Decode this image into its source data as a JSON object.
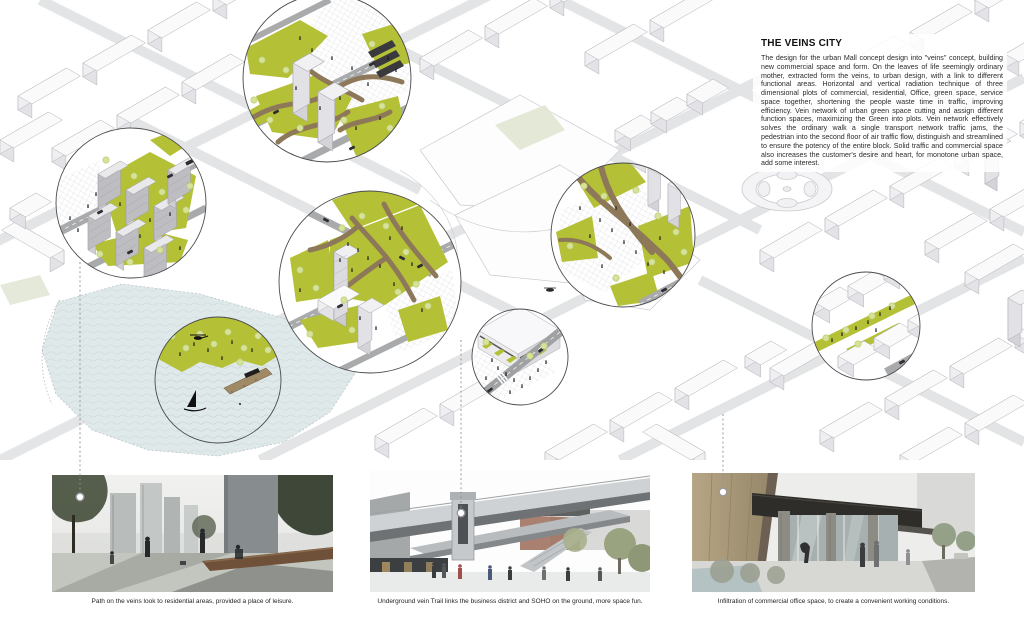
{
  "board": {
    "title": "THE VEINS CITY",
    "description": "The design for the urban Mall concept design into \"veins\" concept, building new commercial space and form. On the leaves of life seemingly ordinary mother, extracted form the veins, to urban design, with a link to different functional areas. Horizontal and vertical radiation technique of three dimensional plots of commercial, residential, Office, green space, service space together, shortening the people waste time in traffic, improving efficiency. Vein network of urban green space cutting and assign different function spaces, maximizing the Green into plots. Vein network effectively solves the ordinary walk a single transport network traffic jams, the pedestrian into the second floor of air traffic flow, distinguish and streamlined to ensure the potency of the entire block. Solid traffic and commercial space also increases the customer's desire and heart, for monotone urban space, add some interest."
  },
  "captions": [
    {
      "text": "Path on the veins look to residential areas, provided a place of leisure."
    },
    {
      "text": "Underground vein Trail links the business district and SOHO on the ground, more space fun."
    },
    {
      "text": "Infiltration of commercial office space, to create a convenient working conditions."
    }
  ],
  "colors": {
    "lawn-green": "#b4c035",
    "tree-green": "#d6e29a",
    "vein-brown": "#8d7859",
    "road-gray": "#a8aaac",
    "water": "#e0e9ea",
    "building-top": "#fafafb",
    "building-side": "#e7e7ea",
    "ink": "#1c1c1c"
  }
}
